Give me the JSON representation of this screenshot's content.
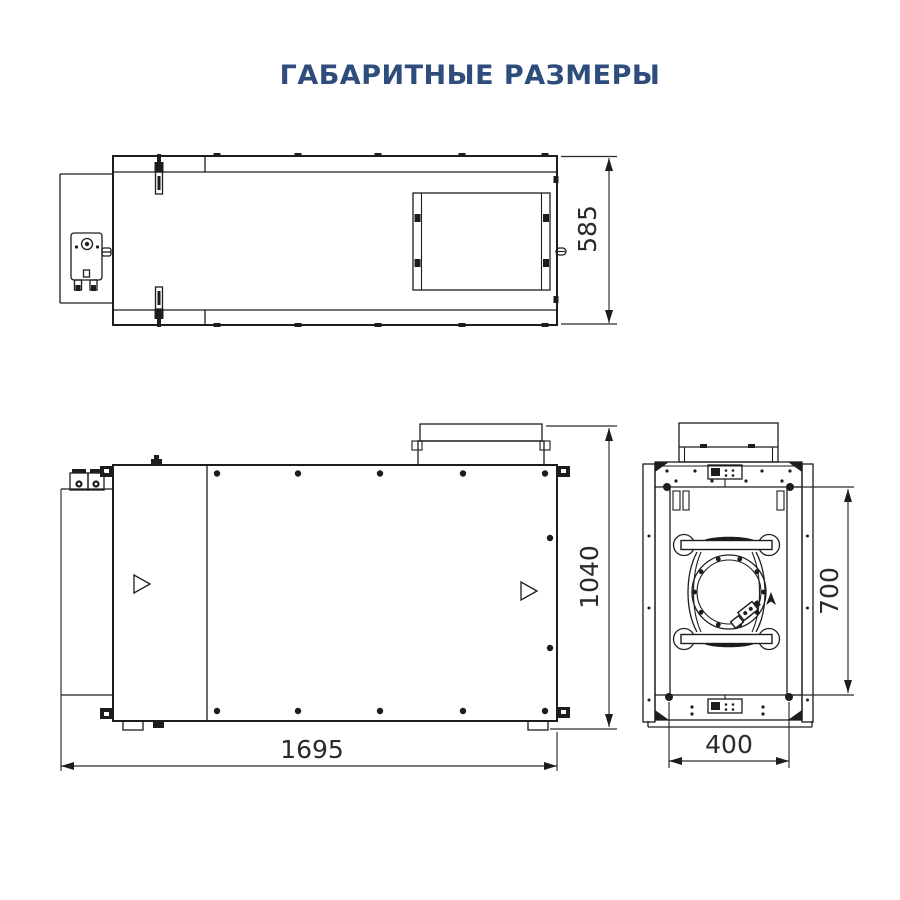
{
  "title": "ГАБАРИТНЫЕ РАЗМЕРЫ",
  "drawing": {
    "kind": "dimensional-drawing",
    "dimensions": {
      "top_depth": "585",
      "front_height": "1040",
      "front_length": "1695",
      "side_width": "400",
      "side_opening_height": "700"
    }
  },
  "colors": {
    "title_text": "#2e4d7c",
    "line": "#1d1d1d",
    "dimension_text": "#2a2a2a",
    "background": "#ffffff"
  },
  "icons": {
    "airflow_marker": "triangle-right",
    "dimension_arrows": "filled-arrowheads"
  }
}
